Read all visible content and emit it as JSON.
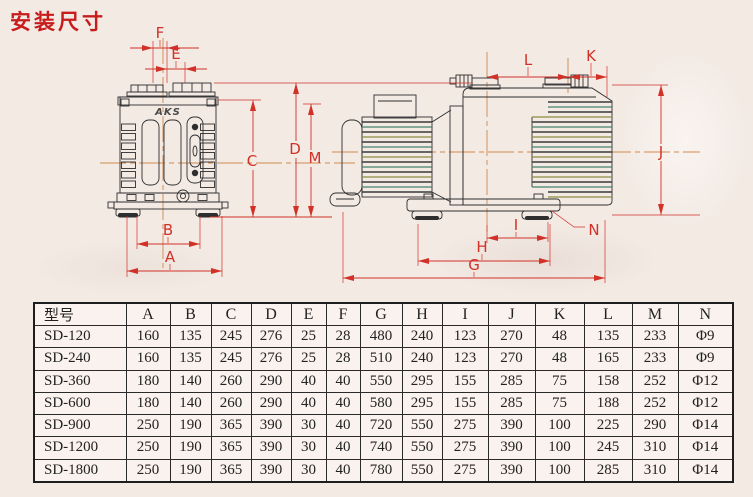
{
  "title": "安装尺寸",
  "drawing": {
    "logo": "AKS",
    "labels": {
      "A": "A",
      "B": "B",
      "C": "C",
      "D": "D",
      "E": "E",
      "F": "F",
      "G": "G",
      "H": "H",
      "I": "I",
      "J": "J",
      "K": "K",
      "L": "L",
      "M": "M",
      "N": "N"
    }
  },
  "colors": {
    "accent_red": "#c81c1c",
    "dimension_red": "#d23128",
    "centerline_orange": "#cf8a4e",
    "line_black": "#2e2e2e",
    "paper": "#f3eae4"
  },
  "table": {
    "model_header": "型号",
    "dim_headers": [
      "A",
      "B",
      "C",
      "D",
      "E",
      "F",
      "G",
      "H",
      "I",
      "J",
      "K",
      "L",
      "M",
      "N"
    ],
    "rows": [
      {
        "model": "SD-120",
        "values": [
          "160",
          "135",
          "245",
          "276",
          "25",
          "28",
          "480",
          "240",
          "123",
          "270",
          "48",
          "135",
          "233",
          "Φ9"
        ]
      },
      {
        "model": "SD-240",
        "values": [
          "160",
          "135",
          "245",
          "276",
          "25",
          "28",
          "510",
          "240",
          "123",
          "270",
          "48",
          "165",
          "233",
          "Φ9"
        ]
      },
      {
        "model": "SD-360",
        "values": [
          "180",
          "140",
          "260",
          "290",
          "40",
          "40",
          "550",
          "295",
          "155",
          "285",
          "75",
          "158",
          "252",
          "Φ12"
        ]
      },
      {
        "model": "SD-600",
        "values": [
          "180",
          "140",
          "260",
          "290",
          "40",
          "40",
          "580",
          "295",
          "155",
          "285",
          "75",
          "188",
          "252",
          "Φ12"
        ]
      },
      {
        "model": "SD-900",
        "values": [
          "250",
          "190",
          "365",
          "390",
          "30",
          "40",
          "720",
          "550",
          "275",
          "390",
          "100",
          "225",
          "290",
          "Φ14"
        ]
      },
      {
        "model": "SD-1200",
        "values": [
          "250",
          "190",
          "365",
          "390",
          "30",
          "40",
          "740",
          "550",
          "275",
          "390",
          "100",
          "245",
          "310",
          "Φ14"
        ]
      },
      {
        "model": "SD-1800",
        "values": [
          "250",
          "190",
          "365",
          "390",
          "30",
          "40",
          "780",
          "550",
          "275",
          "390",
          "100",
          "285",
          "310",
          "Φ14"
        ]
      }
    ]
  }
}
